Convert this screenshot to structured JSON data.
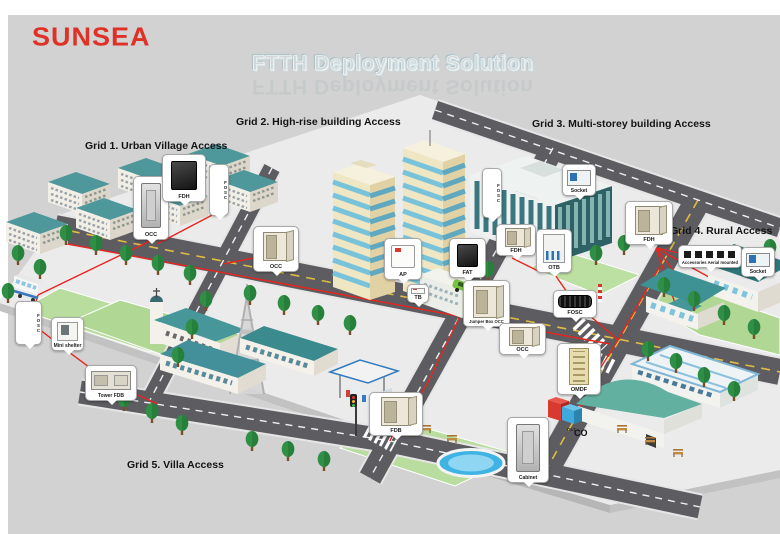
{
  "page": {
    "background": "#d2d2d2",
    "frame": "#ffffff"
  },
  "logo": {
    "text": "SUNSEA",
    "color": "#e03127"
  },
  "title": {
    "text": "FTTH Deployment Solution"
  },
  "grids": [
    {
      "label": "Grid 1. Urban Village Access",
      "x": 85,
      "y": 140
    },
    {
      "label": "Grid 2. High-rise building Access",
      "x": 236,
      "y": 116
    },
    {
      "label": "Grid 3. Multi-storey building Access",
      "x": 532,
      "y": 118
    },
    {
      "label": "Grid 4. Rural Access",
      "x": 670,
      "y": 225
    },
    {
      "label": "Grid 5. Villa Access",
      "x": 127,
      "y": 459
    }
  ],
  "callouts": [
    {
      "label": "OCC",
      "kind": "cabinet",
      "x": 133,
      "y": 176,
      "w": 36,
      "h": 64
    },
    {
      "label": "FDH",
      "kind": "device-dark",
      "x": 162,
      "y": 154,
      "w": 44,
      "h": 48
    },
    {
      "label": "FOSC",
      "kind": "closure-vertical",
      "vertical": true,
      "x": 209,
      "y": 164,
      "w": 20,
      "h": 52
    },
    {
      "label": "OCC",
      "kind": "cabinet-open",
      "x": 253,
      "y": 226,
      "w": 46,
      "h": 46
    },
    {
      "label": "AP",
      "kind": "wallbox",
      "x": 384,
      "y": 238,
      "w": 38,
      "h": 42
    },
    {
      "label": "TB",
      "kind": "small-box",
      "x": 407,
      "y": 284,
      "w": 22,
      "h": 19
    },
    {
      "label": "FAT",
      "kind": "device-dark",
      "x": 449,
      "y": 238,
      "w": 37,
      "h": 40
    },
    {
      "label": "Jumper Box OCC",
      "kind": "cabinet-open",
      "x": 463,
      "y": 280,
      "w": 47,
      "h": 47
    },
    {
      "label": "FOSC",
      "kind": "closure-vertical",
      "vertical": true,
      "x": 482,
      "y": 168,
      "w": 20,
      "h": 50
    },
    {
      "label": "Socket",
      "kind": "socket",
      "x": 562,
      "y": 164,
      "w": 34,
      "h": 32
    },
    {
      "label": "FDH",
      "kind": "cabinet-open",
      "x": 496,
      "y": 224,
      "w": 40,
      "h": 32
    },
    {
      "label": "OTB",
      "kind": "splitter",
      "x": 536,
      "y": 229,
      "w": 36,
      "h": 44
    },
    {
      "label": "FDH",
      "kind": "cabinet-open",
      "x": 625,
      "y": 201,
      "w": 48,
      "h": 44
    },
    {
      "label": "Accessories Aerial mounted",
      "kind": "hardware",
      "x": 678,
      "y": 245,
      "w": 64,
      "h": 23
    },
    {
      "label": "Socket",
      "kind": "socket",
      "x": 741,
      "y": 247,
      "w": 34,
      "h": 30
    },
    {
      "label": "FOSC",
      "kind": "closure-vertical",
      "vertical": true,
      "x": 15,
      "y": 301,
      "w": 27,
      "h": 44
    },
    {
      "label": "Mini shelter",
      "kind": "shelter",
      "x": 51,
      "y": 317,
      "w": 33,
      "h": 34
    },
    {
      "label": "Tower FDB",
      "kind": "cabinet-wide",
      "x": 85,
      "y": 365,
      "w": 52,
      "h": 36
    },
    {
      "label": "FOSC",
      "kind": "closure-horizontal",
      "x": 553,
      "y": 290,
      "w": 44,
      "h": 28
    },
    {
      "label": "OCC",
      "kind": "cabinet-open",
      "x": 499,
      "y": 323,
      "w": 47,
      "h": 32
    },
    {
      "label": "OMDF",
      "kind": "rack",
      "x": 557,
      "y": 343,
      "w": 44,
      "h": 52
    },
    {
      "label": "Cabinet",
      "kind": "cabinet",
      "x": 507,
      "y": 417,
      "w": 42,
      "h": 66
    },
    {
      "label": "FDB",
      "kind": "cabinet-open",
      "x": 369,
      "y": 392,
      "w": 54,
      "h": 44
    }
  ],
  "co": {
    "label": "CO",
    "omdf_label": "OMDF",
    "olt_label": "OLT"
  },
  "colors": {
    "fiber_cable": "#e8251f",
    "logo_red": "#e03127",
    "roof_teal": "#47969a",
    "highrise_cream": "#efe6c4",
    "window_blue": "#79c3da",
    "road_gray": "#5c5c61"
  }
}
